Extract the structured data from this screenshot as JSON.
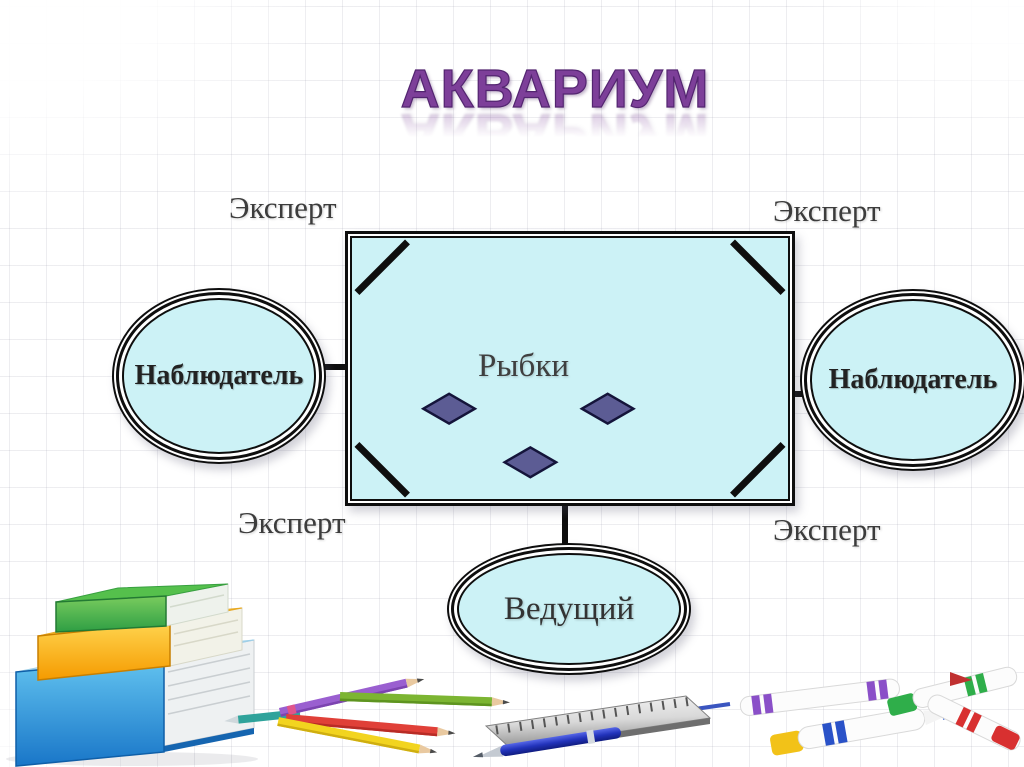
{
  "slide": {
    "title": "АКВАРИУМ",
    "background": "grid-paper"
  },
  "colors": {
    "title_purple": "#7d3f99",
    "shape_fill": "#ccf2f6",
    "diamond_fill": "#5c5c94",
    "outline": "#0e0e0e",
    "label_text": "#3c3c3c"
  },
  "diagram": {
    "fishbowl": {
      "label": "Рыбки",
      "fish_count": 3
    },
    "experts": [
      {
        "label": "Эксперт",
        "position": "top-left"
      },
      {
        "label": "Эксперт",
        "position": "top-right"
      },
      {
        "label": "Эксперт",
        "position": "bottom-left"
      },
      {
        "label": "Эксперт",
        "position": "bottom-right"
      }
    ],
    "observers": [
      {
        "label": "Наблюдатель",
        "position": "left"
      },
      {
        "label": "Наблюдатель",
        "position": "right"
      }
    ],
    "host": {
      "label": "Ведущий"
    }
  },
  "decorations": [
    {
      "icon": "books-stack-icon"
    },
    {
      "icon": "colored-pencils-icon"
    },
    {
      "icon": "ruler-icon"
    },
    {
      "icon": "blue-pen-icon"
    },
    {
      "icon": "white-markers-icon"
    }
  ]
}
